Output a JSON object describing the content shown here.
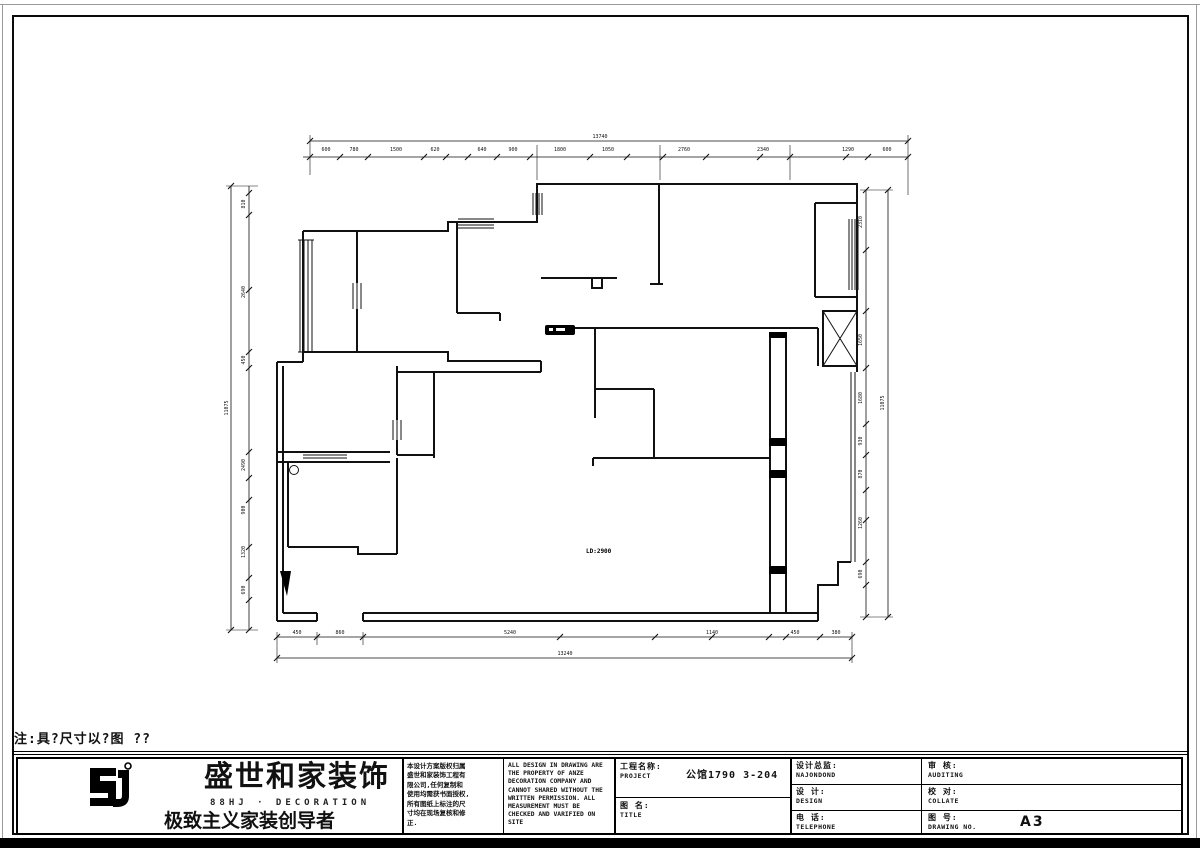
{
  "colors": {
    "line": "#111111",
    "background": "#ffffff",
    "frame": "#0a0a0a"
  },
  "note": "注:具?尺寸以?图 ??",
  "logo": {
    "brand": "盛世和家装饰",
    "sub": "88HJ · DECORATION",
    "slogan": "极致主义家装创导者"
  },
  "title_block": {
    "cn_disclaimer": "本设计方案版权归属\n盛世和家装饰工程有\n限公司,任何复制和\n使用均需获书面授权,\n所有图纸上标注的尺\n寸均在现场复核和修\n正.",
    "en_disclaimer": "ALL DESIGN IN DRAWING ARE\nTHE PROPERTY OF ANZE\nDECORATION COMPANY AND\nCANNOT SHARED WITHOUT THE\nWRITTEN PERMISSION. ALL\nMEASUREMENT MUST BE\nCHECKED AND VARIFIED ON\nSITE",
    "project_label_cn": "工程名称:",
    "project_label_en": "PROJECT",
    "project_value": "公馆1790 3-204",
    "drawing_label_cn": "图 名:",
    "drawing_label_en": "TITLE",
    "director_label_cn": "设计总监:",
    "director_value": "NAJONDOND",
    "design_label_cn": "设 计:",
    "design_label_en": "DESIGN",
    "phone_label_cn": "电 话:",
    "phone_label_en": "TELEPHONE",
    "audit_label_cn": "审 核:",
    "audit_label_en": "AUDITING",
    "collate_label_cn": "校 对:",
    "collate_label_en": "COLLATE",
    "no_label_cn": "图 号:",
    "no_label_en": "DRAWING NO.",
    "no_value": "A3"
  },
  "plan": {
    "room_label": "LD:2900",
    "dimension_labels": [
      {
        "x": 600,
        "y": 138,
        "rot": 0,
        "text": "13740"
      },
      {
        "x": 326,
        "y": 151,
        "rot": 0,
        "text": "600"
      },
      {
        "x": 354,
        "y": 151,
        "rot": 0,
        "text": "780"
      },
      {
        "x": 396,
        "y": 151,
        "rot": 0,
        "text": "1500"
      },
      {
        "x": 435,
        "y": 151,
        "rot": 0,
        "text": "620"
      },
      {
        "x": 482,
        "y": 151,
        "rot": 0,
        "text": "640"
      },
      {
        "x": 513,
        "y": 151,
        "rot": 0,
        "text": "900"
      },
      {
        "x": 560,
        "y": 151,
        "rot": 0,
        "text": "1800"
      },
      {
        "x": 608,
        "y": 151,
        "rot": 0,
        "text": "1050"
      },
      {
        "x": 684,
        "y": 151,
        "rot": 0,
        "text": "2760"
      },
      {
        "x": 763,
        "y": 151,
        "rot": 0,
        "text": "2340"
      },
      {
        "x": 848,
        "y": 151,
        "rot": 0,
        "text": "1290"
      },
      {
        "x": 887,
        "y": 151,
        "rot": 0,
        "text": "600"
      },
      {
        "x": 245,
        "y": 204,
        "rot": -90,
        "text": "810"
      },
      {
        "x": 245,
        "y": 292,
        "rot": -90,
        "text": "2640"
      },
      {
        "x": 245,
        "y": 360,
        "rot": -90,
        "text": "450"
      },
      {
        "x": 245,
        "y": 465,
        "rot": -90,
        "text": "2490"
      },
      {
        "x": 245,
        "y": 510,
        "rot": -90,
        "text": "900"
      },
      {
        "x": 245,
        "y": 552,
        "rot": -90,
        "text": "1320"
      },
      {
        "x": 245,
        "y": 590,
        "rot": -90,
        "text": "690"
      },
      {
        "x": 228,
        "y": 408,
        "rot": -90,
        "text": "11075"
      },
      {
        "x": 862,
        "y": 222,
        "rot": -90,
        "text": "2310"
      },
      {
        "x": 862,
        "y": 340,
        "rot": -90,
        "text": "1650"
      },
      {
        "x": 862,
        "y": 398,
        "rot": -90,
        "text": "1680"
      },
      {
        "x": 862,
        "y": 441,
        "rot": -90,
        "text": "930"
      },
      {
        "x": 862,
        "y": 474,
        "rot": -90,
        "text": "870"
      },
      {
        "x": 862,
        "y": 523,
        "rot": -90,
        "text": "1260"
      },
      {
        "x": 862,
        "y": 574,
        "rot": -90,
        "text": "690"
      },
      {
        "x": 884,
        "y": 403,
        "rot": -90,
        "text": "11075"
      },
      {
        "x": 297,
        "y": 634,
        "rot": 0,
        "text": "450"
      },
      {
        "x": 340,
        "y": 634,
        "rot": 0,
        "text": "860"
      },
      {
        "x": 510,
        "y": 634,
        "rot": 0,
        "text": "5240"
      },
      {
        "x": 712,
        "y": 634,
        "rot": 0,
        "text": "1140"
      },
      {
        "x": 795,
        "y": 634,
        "rot": 0,
        "text": "450"
      },
      {
        "x": 836,
        "y": 634,
        "rot": 0,
        "text": "380"
      },
      {
        "x": 565,
        "y": 655,
        "rot": 0,
        "text": "13240"
      }
    ]
  }
}
